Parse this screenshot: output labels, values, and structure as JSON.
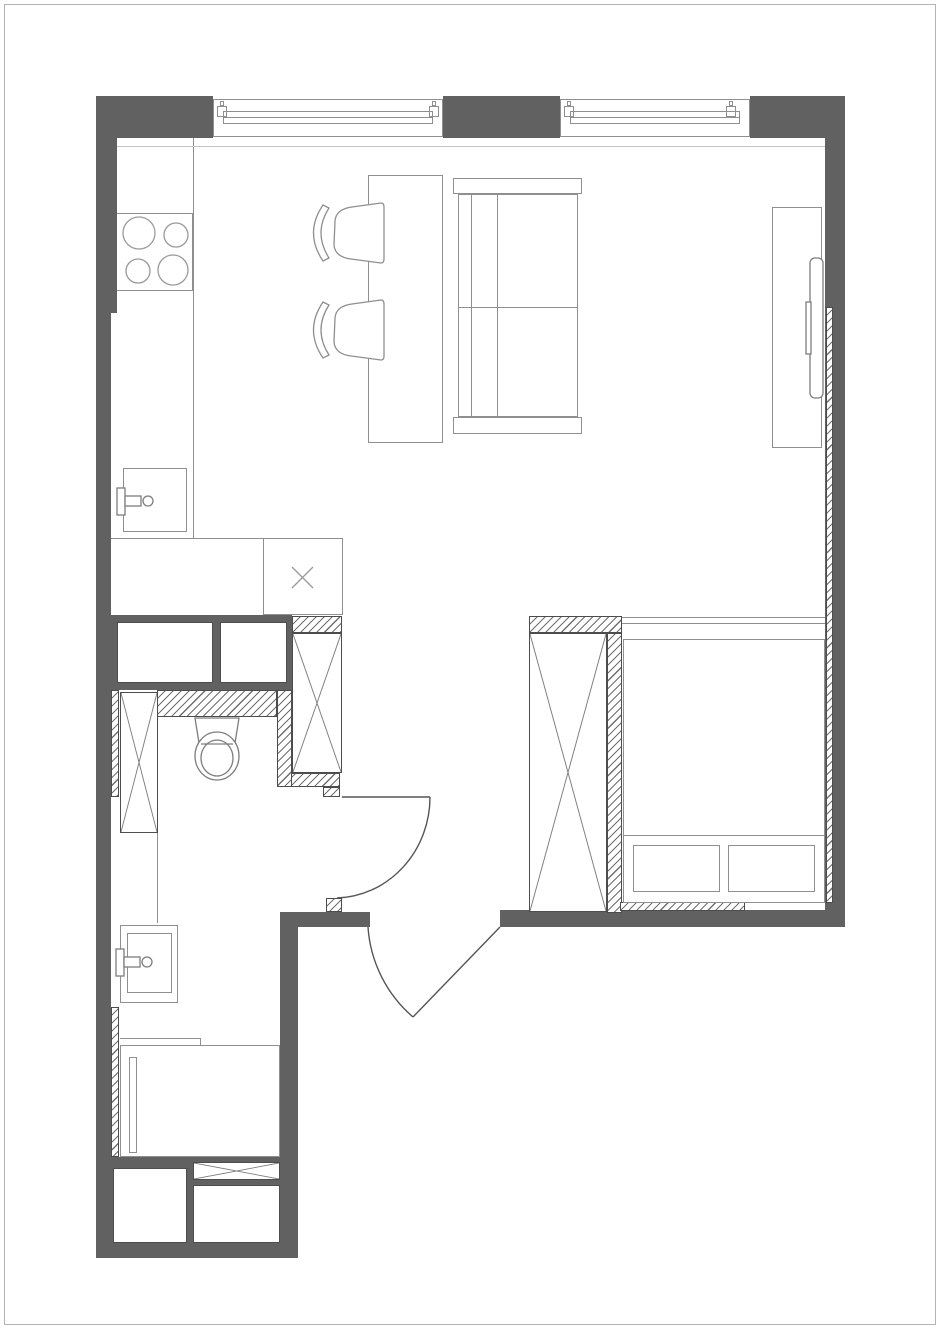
{
  "plan": {
    "name": "studio-apartment-floor-plan",
    "rooms": [
      "kitchen-living-room",
      "bedroom-area",
      "bathroom",
      "entry-hall"
    ],
    "inventory": [
      "stove-4-burners",
      "kitchen-counter",
      "kitchen-sink",
      "appliance-square-x",
      "dining-table",
      "dining-chair",
      "dining-chair",
      "sofa",
      "tv-console",
      "tv",
      "wardrobe-x",
      "bed",
      "pillow",
      "pillow",
      "toilet",
      "bathroom-sink",
      "shower-tray",
      "storage-boxes",
      "entry-door",
      "bathroom-door",
      "window",
      "window"
    ]
  },
  "colors": {
    "wall": "#616161",
    "furniture_line": "#8f8f8f",
    "dark_line": "#4d4d4d",
    "hatch_line": "#6f6f6f",
    "frame_border": "#b3b3b3",
    "background": "#ffffff"
  },
  "geometry": {
    "walls": [
      {
        "name": "wall-top-left-corner",
        "x": 96,
        "y": 96,
        "w": 117,
        "h": 42
      },
      {
        "name": "wall-window-pier",
        "x": 443,
        "y": 96,
        "w": 117,
        "h": 42
      },
      {
        "name": "wall-top-right-corner",
        "x": 750,
        "y": 96,
        "w": 95,
        "h": 42
      },
      {
        "name": "wall-right",
        "x": 825,
        "y": 138,
        "w": 20,
        "h": 789
      },
      {
        "name": "wall-left-upper",
        "x": 96,
        "y": 96,
        "w": 21,
        "h": 217
      },
      {
        "name": "wall-left-lower",
        "x": 96,
        "y": 313,
        "w": 15,
        "h": 945
      },
      {
        "name": "wall-bath-top-block",
        "x": 111,
        "y": 615,
        "w": 181,
        "h": 75
      },
      {
        "name": "wall-entry-left",
        "x": 282,
        "y": 912,
        "w": 88,
        "h": 15
      },
      {
        "name": "wall-bottom-bedroom",
        "x": 500,
        "y": 910,
        "w": 345,
        "h": 17
      },
      {
        "name": "wall-lower-bath-right",
        "x": 280,
        "y": 912,
        "w": 18,
        "h": 346
      },
      {
        "name": "wall-bottom",
        "x": 96,
        "y": 1243,
        "w": 202,
        "h": 15
      },
      {
        "name": "wall-lower-bath-block",
        "x": 111,
        "y": 1157,
        "w": 187,
        "h": 88
      }
    ],
    "hatches": [
      {
        "name": "hatch-bedroom-wardrobe-top",
        "x": 529,
        "y": 616,
        "w": 93,
        "h": 17
      },
      {
        "name": "hatch-bedroom-wardrobe-right",
        "x": 607,
        "y": 633,
        "w": 15,
        "h": 280
      },
      {
        "name": "hatch-bed-bottom",
        "x": 620,
        "y": 902,
        "w": 125,
        "h": 9
      },
      {
        "name": "hatch-right-wall-lining",
        "x": 826,
        "y": 307,
        "w": 7,
        "h": 596
      },
      {
        "name": "hatch-bath-column-top",
        "x": 292,
        "y": 616,
        "w": 50,
        "h": 17
      },
      {
        "name": "hatch-bath-column-bottom",
        "x": 287,
        "y": 773,
        "w": 53,
        "h": 14
      },
      {
        "name": "hatch-bath-right",
        "x": 277,
        "y": 690,
        "w": 15,
        "h": 97
      },
      {
        "name": "hatch-bath-top",
        "x": 157,
        "y": 690,
        "w": 120,
        "h": 27
      },
      {
        "name": "hatch-left-upper",
        "x": 111,
        "y": 690,
        "w": 8,
        "h": 107
      },
      {
        "name": "hatch-left-lower",
        "x": 111,
        "y": 1007,
        "w": 8,
        "h": 150
      },
      {
        "name": "hatch-door-jamb",
        "x": 326,
        "y": 898,
        "w": 16,
        "h": 14
      },
      {
        "name": "hatch-door-notch",
        "x": 323,
        "y": 787,
        "w": 17,
        "h": 10
      }
    ],
    "white_boxes": [
      {
        "name": "niche-left",
        "x": 117,
        "y": 622,
        "w": 96,
        "h": 61
      },
      {
        "name": "niche-right",
        "x": 220,
        "y": 622,
        "w": 67,
        "h": 61
      },
      {
        "name": "storage-box-left",
        "x": 113,
        "y": 1168,
        "w": 74,
        "h": 75
      },
      {
        "name": "storage-box-right",
        "x": 193,
        "y": 1185,
        "w": 87,
        "h": 58
      }
    ],
    "x_boxes": [
      {
        "name": "wardrobe-bedroom",
        "x": 529,
        "y": 633,
        "w": 78,
        "h": 279
      },
      {
        "name": "shaft-bath",
        "x": 292,
        "y": 633,
        "w": 50,
        "h": 140
      },
      {
        "name": "cabinet-bath",
        "x": 120,
        "y": 692,
        "w": 38,
        "h": 141
      },
      {
        "name": "storage-flat-box",
        "x": 193,
        "y": 1162,
        "w": 87,
        "h": 18
      }
    ],
    "outlines": [
      {
        "name": "stove",
        "x": 117,
        "y": 213,
        "w": 76,
        "h": 78,
        "b": "trb"
      },
      {
        "name": "appliance-square",
        "x": 263,
        "y": 538,
        "w": 80,
        "h": 77
      },
      {
        "name": "kitchen-sink-cabinet",
        "x": 123,
        "y": 468,
        "w": 64,
        "h": 64
      },
      {
        "name": "dining-table",
        "x": 368,
        "y": 175,
        "w": 75,
        "h": 268
      },
      {
        "name": "sofa-armrest-top",
        "x": 453,
        "y": 178,
        "w": 129,
        "h": 16
      },
      {
        "name": "sofa-body",
        "x": 458,
        "y": 194,
        "w": 120,
        "h": 223
      },
      {
        "name": "sofa-armrest-bottom",
        "x": 453,
        "y": 417,
        "w": 129,
        "h": 17
      },
      {
        "name": "tv-console",
        "x": 772,
        "y": 207,
        "w": 50,
        "h": 241
      },
      {
        "name": "bed",
        "x": 623,
        "y": 639,
        "w": 202,
        "h": 264
      },
      {
        "name": "pillow-left",
        "x": 633,
        "y": 845,
        "w": 87,
        "h": 47
      },
      {
        "name": "pillow-right",
        "x": 728,
        "y": 845,
        "w": 87,
        "h": 47
      },
      {
        "name": "bath-sink-outer",
        "x": 120,
        "y": 925,
        "w": 58,
        "h": 78
      },
      {
        "name": "bath-sink-inner",
        "x": 127,
        "y": 933,
        "w": 45,
        "h": 60
      },
      {
        "name": "shower-tray",
        "x": 120,
        "y": 1045,
        "w": 160,
        "h": 112
      },
      {
        "name": "shower-screen",
        "x": 129,
        "y": 1057,
        "w": 8,
        "h": 96
      },
      {
        "name": "cabinet-bath-extension",
        "x": 120,
        "y": 833,
        "w": 38,
        "h": 90,
        "b": "r"
      },
      {
        "name": "window-1-frame",
        "x": 213,
        "y": 99,
        "w": 230,
        "h": 38
      },
      {
        "name": "window-2-frame",
        "x": 560,
        "y": 99,
        "w": 190,
        "h": 38
      },
      {
        "name": "window-1-sash",
        "x": 223,
        "y": 111,
        "w": 210,
        "h": 13
      },
      {
        "name": "window-2-sash",
        "x": 570,
        "y": 111,
        "w": 170,
        "h": 13
      },
      {
        "name": "window-1-cap-left",
        "x": 217,
        "y": 106,
        "w": 10,
        "h": 11
      },
      {
        "name": "window-1-cap-right",
        "x": 429,
        "y": 106,
        "w": 10,
        "h": 11
      },
      {
        "name": "window-2-cap-left",
        "x": 564,
        "y": 106,
        "w": 10,
        "h": 11
      },
      {
        "name": "window-2-cap-right",
        "x": 726,
        "y": 106,
        "w": 10,
        "h": 11
      },
      {
        "name": "window-1-tick-left",
        "x": 220,
        "y": 101,
        "w": 4,
        "h": 5
      },
      {
        "name": "window-1-tick-right",
        "x": 432,
        "y": 101,
        "w": 4,
        "h": 5
      },
      {
        "name": "window-2-tick-left",
        "x": 567,
        "y": 101,
        "w": 4,
        "h": 5
      },
      {
        "name": "window-2-tick-right",
        "x": 729,
        "y": 101,
        "w": 4,
        "h": 5
      }
    ],
    "lines": [
      {
        "name": "counter-edge",
        "x": 193,
        "y": 138,
        "w": 0,
        "h": 400
      },
      {
        "name": "counter-return",
        "x": 111,
        "y": 538,
        "w": 232,
        "h": 0
      },
      {
        "name": "sofa-back-line-1",
        "x": 471,
        "y": 194,
        "w": 0,
        "h": 223
      },
      {
        "name": "sofa-back-line-2",
        "x": 497,
        "y": 194,
        "w": 0,
        "h": 223
      },
      {
        "name": "sofa-seat-line",
        "x": 458,
        "y": 307,
        "w": 120,
        "h": 0
      },
      {
        "name": "bed-blanket-line",
        "x": 623,
        "y": 835,
        "w": 202,
        "h": 0
      },
      {
        "name": "bed-head-line-1",
        "x": 622,
        "y": 617,
        "w": 203,
        "h": 0
      },
      {
        "name": "bed-head-line-2",
        "x": 622,
        "y": 623,
        "w": 203,
        "h": 0
      },
      {
        "name": "window-sill-line",
        "x": 117,
        "y": 146,
        "w": 708,
        "h": 0,
        "cls": "light"
      },
      {
        "name": "window-1-sash-mid",
        "x": 223,
        "y": 117,
        "w": 210,
        "h": 0
      },
      {
        "name": "window-2-sash-mid",
        "x": 570,
        "y": 117,
        "w": 170,
        "h": 0
      },
      {
        "name": "shower-top-line",
        "x": 120,
        "y": 1038,
        "w": 80,
        "h": 0
      },
      {
        "name": "shower-top-tick",
        "x": 200,
        "y": 1038,
        "w": 0,
        "h": 7
      }
    ]
  }
}
